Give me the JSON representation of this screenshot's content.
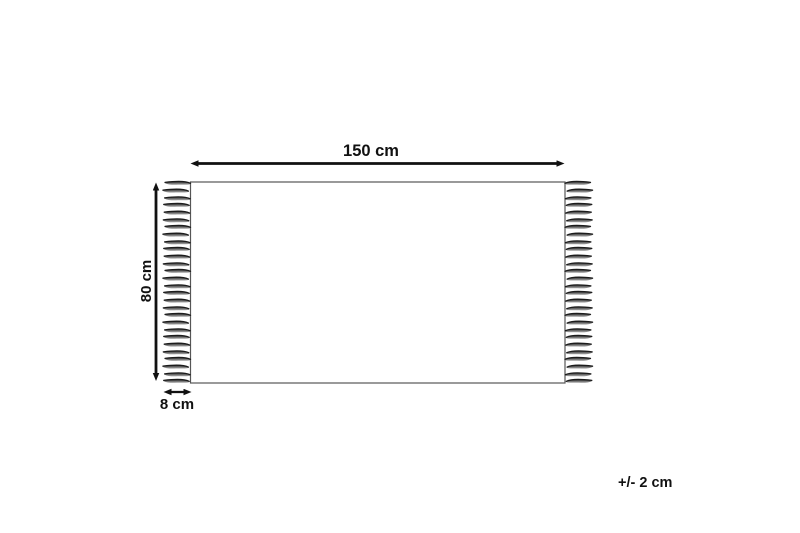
{
  "diagram": {
    "type": "product-dimension-diagram",
    "subject": "rug-with-fringes",
    "labels": {
      "width": "150 cm",
      "height": "80 cm",
      "fringe": "8 cm",
      "tolerance": "+/- 2 cm"
    },
    "dimensions": {
      "rug_width_cm": 150,
      "rug_height_cm": 80,
      "fringe_length_cm": 8,
      "tolerance_cm": 2
    },
    "colors": {
      "background": "#ffffff",
      "rug_fill": "#ffffff",
      "rug_outline": "#565656",
      "arrow": "#111111",
      "label_text": "#111111",
      "fringe_dark": "#1c1c1c",
      "fringe_mid": "#6e6e6e",
      "fringe_light": "#b4b4b4"
    },
    "fringes": {
      "per_side": 28,
      "sides": [
        "left",
        "right"
      ]
    }
  }
}
